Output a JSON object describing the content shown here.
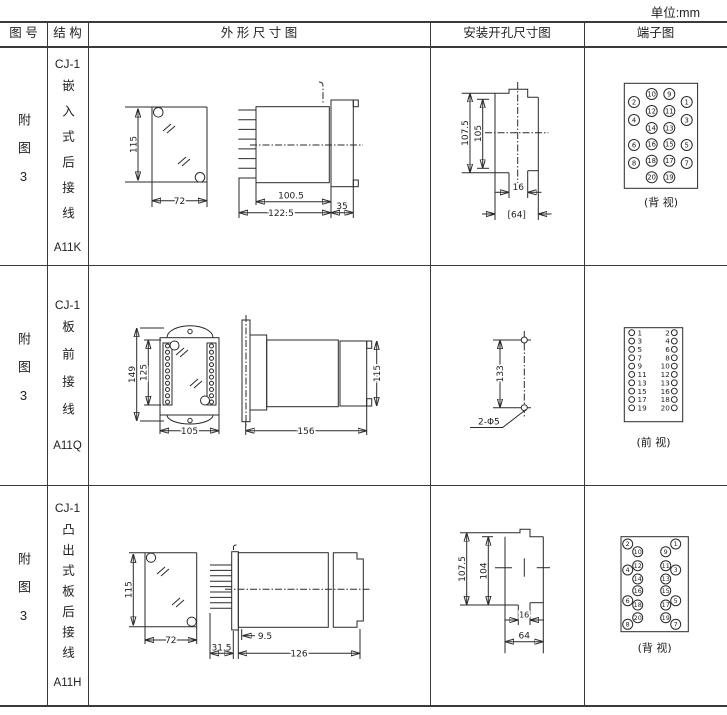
{
  "unit_label": "单位:mm",
  "headers": {
    "fig_no": "图 号",
    "structure": "结 构",
    "outline": "外 形 尺 寸 图",
    "install": "安装开孔尺寸图",
    "terminal": "端子图"
  },
  "rows": [
    {
      "fig_no": "附图3",
      "model": "CJ-1",
      "structure": "嵌入式后接线",
      "code": "A11K",
      "outline": {
        "height": "115",
        "width": "72",
        "body_len": "100.5",
        "total_len": "122.5",
        "flange_len": "35"
      },
      "install": {
        "outer_h": "107.5",
        "inner_h": "105",
        "slot_w": "16",
        "open_w": "[64]"
      },
      "terminal": {
        "style": "quad",
        "columns": [
          [
            2,
            4,
            6,
            8
          ],
          [
            10,
            12,
            14,
            16,
            18,
            20
          ],
          [
            9,
            11,
            13,
            15,
            17,
            19
          ],
          [
            1,
            3,
            5,
            7
          ]
        ],
        "label": "(背 视)"
      }
    },
    {
      "fig_no": "附图3",
      "model": "CJ-1",
      "structure": "板前接线",
      "code": "A11Q",
      "outline": {
        "outer_h": "149",
        "inner_h": "125",
        "width": "105",
        "total_len": "156",
        "side_h": "115"
      },
      "install": {
        "hole_dist": "133",
        "hole_label": "2-Φ5"
      },
      "terminal": {
        "style": "dual",
        "left": [
          1,
          3,
          5,
          7,
          9,
          11,
          13,
          15,
          17,
          19
        ],
        "right": [
          2,
          4,
          6,
          8,
          10,
          12,
          13,
          16,
          18,
          20
        ],
        "label": "(前 视)"
      }
    },
    {
      "fig_no": "附图3",
      "model": "CJ-1",
      "structure": "凸出式板后接线",
      "code": "A11H",
      "outline": {
        "height": "115",
        "width": "72",
        "pin_len": "31.5",
        "offset": "9.5",
        "body_len": "126"
      },
      "install": {
        "outer_h": "107.5",
        "inner_h": "104",
        "slot_w": "16",
        "open_w": "64"
      },
      "terminal": {
        "style": "quad",
        "columns": [
          [
            2,
            4,
            6,
            8
          ],
          [
            10,
            12,
            14,
            16,
            18,
            20
          ],
          [
            9,
            11,
            13,
            15,
            17,
            19
          ],
          [
            1,
            3,
            5,
            7
          ]
        ],
        "label": "(背 视)"
      }
    }
  ]
}
